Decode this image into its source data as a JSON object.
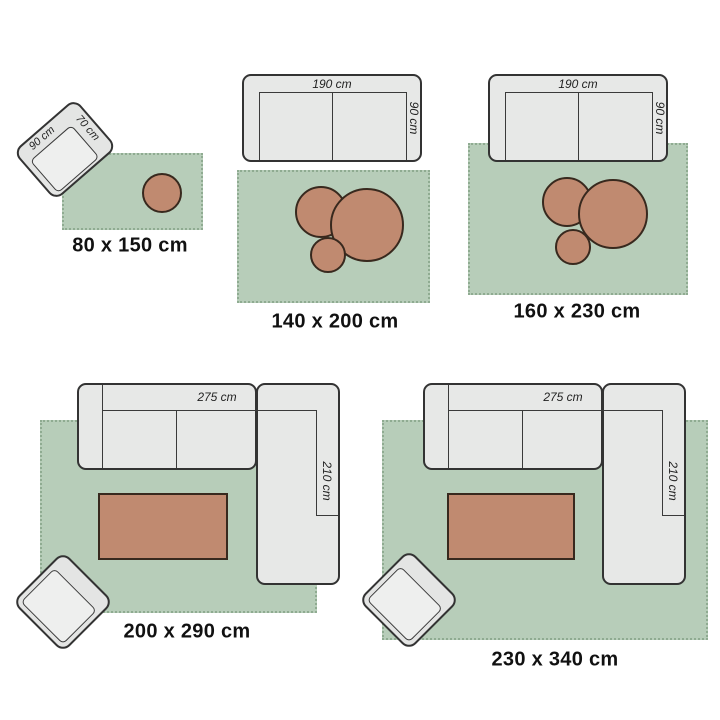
{
  "colors": {
    "rug_green": "#b7cdb9",
    "rug_fringe": "#8fab91",
    "furniture_gray": "#e7e8e7",
    "furniture_outline": "#333333",
    "table_wood": "#c08a70",
    "table_outline": "#38291e",
    "label_text": "#111111"
  },
  "diagrams": [
    {
      "name": "rug-80x150",
      "size_label": "80 x 150 cm",
      "furniture_shapes": [
        "armchair",
        "round-side-table"
      ],
      "armchair": {
        "width_label": "90 cm",
        "depth_label": "70 cm"
      }
    },
    {
      "name": "rug-140x200",
      "size_label": "140 x 200 cm",
      "furniture_shapes": [
        "two-seat-sofa",
        "nesting-round-tables"
      ],
      "sofa": {
        "width_label": "190 cm",
        "depth_label": "90 cm"
      }
    },
    {
      "name": "rug-160x230",
      "size_label": "160 x 230 cm",
      "furniture_shapes": [
        "two-seat-sofa",
        "nesting-round-tables"
      ],
      "sofa": {
        "width_label": "190 cm",
        "depth_label": "90 cm"
      }
    },
    {
      "name": "rug-200x290",
      "size_label": "200 x 290 cm",
      "furniture_shapes": [
        "corner-sofa",
        "coffee-table",
        "armchair"
      ],
      "sofa": {
        "width_label": "275 cm",
        "depth_label": "210 cm"
      }
    },
    {
      "name": "rug-230x340",
      "size_label": "230 x 340 cm",
      "furniture_shapes": [
        "corner-sofa",
        "coffee-table",
        "armchair"
      ],
      "sofa": {
        "width_label": "275 cm",
        "depth_label": "210 cm"
      }
    }
  ]
}
